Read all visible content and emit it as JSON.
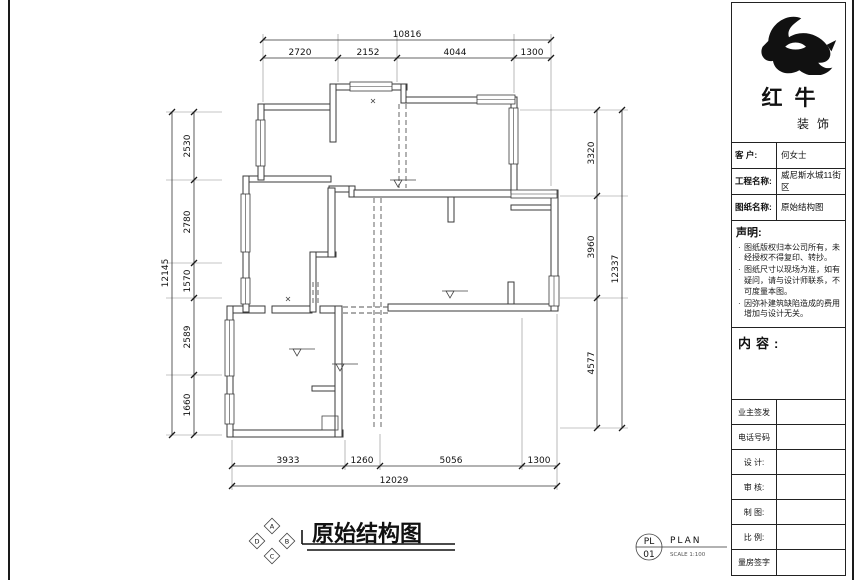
{
  "sheet": {
    "title": "原始结构图",
    "compass": [
      "A",
      "B",
      "C",
      "D"
    ],
    "stamp": {
      "code": "PL",
      "number": "01",
      "label": "PLAN",
      "scale": "SCALE 1:100"
    }
  },
  "dimensions": {
    "top": {
      "total": "10816",
      "segments": [
        "2720",
        "2152",
        "4044",
        "1300"
      ]
    },
    "left": {
      "total": "12145",
      "segments": [
        "2530",
        "2780",
        "1570",
        "2589",
        "1660"
      ]
    },
    "right": {
      "total": "12337",
      "segments": [
        "3320",
        "3960",
        "4577"
      ]
    },
    "bottom": {
      "total": "12029",
      "segments": [
        "3933",
        "1260",
        "5056",
        "1300"
      ]
    }
  },
  "panel": {
    "logo": {
      "name": "红牛",
      "subname": "装饰"
    },
    "info": [
      {
        "label": "客 户:",
        "value": "何女士"
      },
      {
        "label": "工程名称:",
        "value": "威尼斯水城11街区"
      },
      {
        "label": "图纸名称:",
        "value": "原始结构图"
      }
    ],
    "statement": {
      "title": "声明:",
      "items": [
        "图纸版权归本公司所有，未经授权不得复印、转抄。",
        "图纸尺寸以现场为准，如有疑问，请与设计师联系，不可度量本图。",
        "因弥补建筑缺陷造成的费用增加与设计无关。"
      ]
    },
    "content_title": "内容:",
    "fields": [
      "业主签发",
      "电话号码",
      "设 计:",
      "审 核:",
      "制 图:",
      "比 例:",
      "量房签字"
    ]
  }
}
